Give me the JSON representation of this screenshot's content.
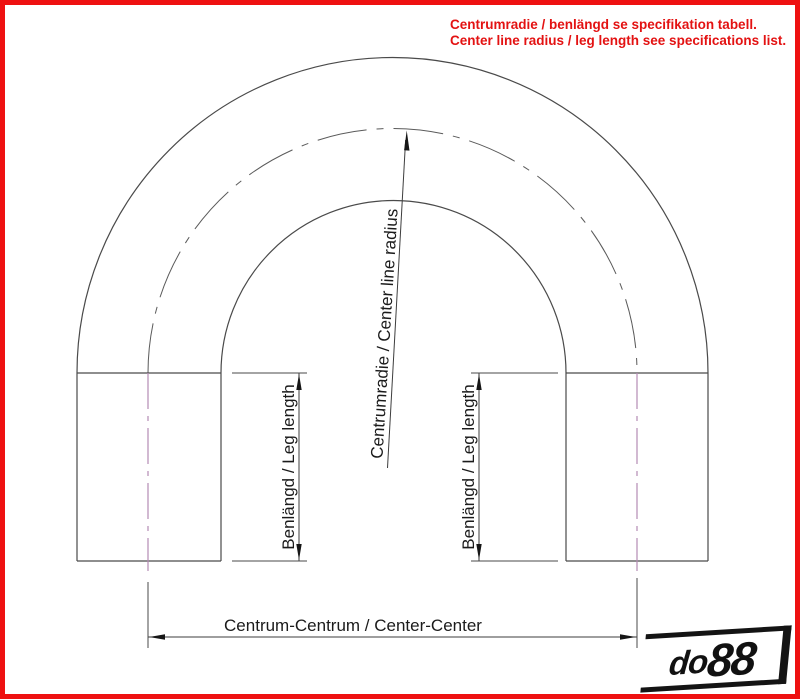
{
  "note": {
    "line1": "Centrumradie / benlängd se specifikation tabell.",
    "line2": "Center line radius / leg length see specifications list."
  },
  "labels": {
    "center_line_radius": "Centrumradie / Center line radius",
    "leg_length_left": "Benlängd / Leg length",
    "leg_length_right": "Benlängd / Leg length",
    "center_center": "Centrum-Centrum / Center-Center"
  },
  "logo": {
    "part1": "do",
    "part2": "88"
  },
  "colors": {
    "frame_red": "#ee1111",
    "note_red": "#e31212",
    "drawing_line": "#4a4a4a",
    "centerline_purple": "#b58bb5",
    "text_black": "#1b1b1b"
  }
}
